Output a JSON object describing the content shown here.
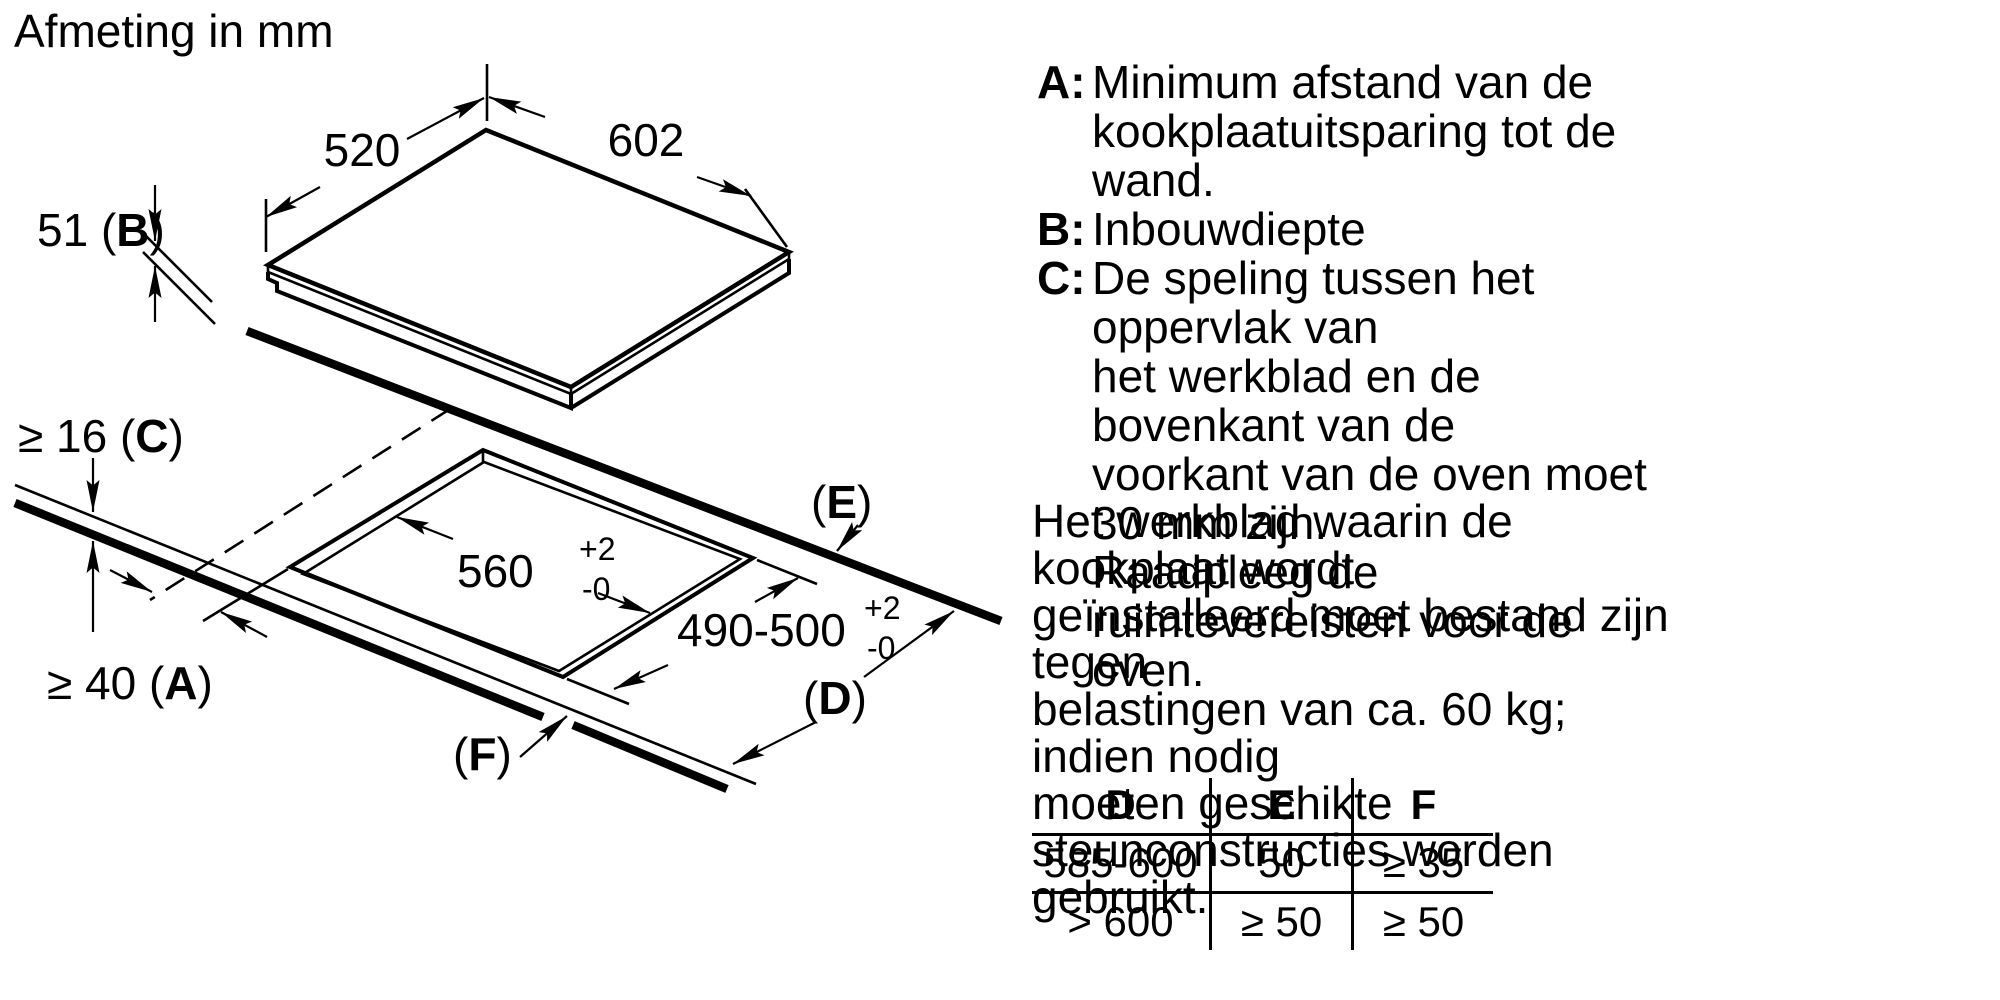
{
  "title": "Afmeting in mm",
  "diagram": {
    "dims": {
      "d520": "520",
      "d602": "602",
      "b": {
        "pre": "51 (",
        "letter": "B",
        "post": ")"
      },
      "c": {
        "pre": "≥ 16 (",
        "letter": "C",
        "post": ")"
      },
      "a": {
        "pre": "≥ 40 (",
        "letter": "A",
        "post": ")"
      },
      "cutout_width": {
        "main": "560",
        "sup": "+2",
        "sub": "-0"
      },
      "cutout_depth": {
        "main": "490-500",
        "sup": "+2",
        "sub": "-0"
      },
      "d": {
        "pre": "(",
        "letter": "D",
        "post": ")"
      },
      "e": {
        "pre": "(",
        "letter": "E",
        "post": ")"
      },
      "f": {
        "pre": "(",
        "letter": "F",
        "post": ")"
      }
    }
  },
  "legend": {
    "items": [
      {
        "letter": "A:",
        "text": "Minimum afstand van de\nkookplaatuitsparing tot de wand."
      },
      {
        "letter": "B:",
        "text": "Inbouwdiepte"
      },
      {
        "letter": "C:",
        "text": "De speling tussen het oppervlak van\nhet werkblad en de bovenkant van de\nvoorkant van de oven moet 30 mm zijn.\nRaadpleeg de ruimtevereisten voor de\noven."
      }
    ],
    "paragraph": "Het werkblad waarin de kookplaat wordt\ngeïnstalleerd moet bestand zijn tegen\nbelastingen van ca. 60 kg; indien nodig\nmoeten geschikte steunconstructies worden\ngebruikt."
  },
  "table": {
    "headers": [
      "D",
      "E",
      "F"
    ],
    "rows": [
      [
        "585-600",
        "50",
        "≥ 35"
      ],
      [
        "> 600",
        "≥ 50",
        "≥ 50"
      ]
    ]
  }
}
